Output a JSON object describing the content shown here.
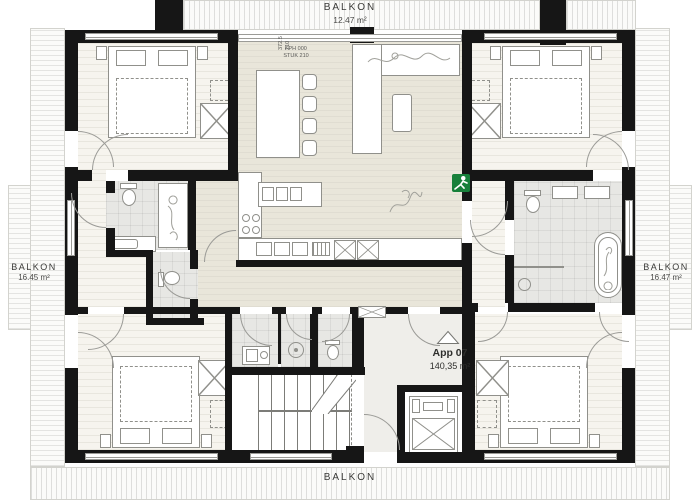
{
  "apartment": {
    "name": "App 07",
    "area": "140,35 m²"
  },
  "balconies": {
    "top": {
      "label": "BALKON",
      "area": "12.47 m²"
    },
    "left": {
      "label": "BALKON",
      "area": "16.45 m²"
    },
    "right": {
      "label": "BALKON",
      "area": "16.47 m²"
    },
    "bottom": {
      "label": "BALKON"
    }
  },
  "annotations": {
    "door_dim_a": "372.5",
    "door_dim_b": "210",
    "door_note_1": "FPH 000",
    "door_note_2": "STUK 210"
  },
  "icons": {
    "exit_sign": "emergency-exit-icon",
    "north_marker": "triangle-marker-icon"
  },
  "colors": {
    "wall": "#161616",
    "exit-green": "#17803a",
    "floor-living": "#e9e6da",
    "floor-bedroom": "#f6f4ee",
    "floor-bath": "#e7e7e4",
    "text": "#3b3b39"
  }
}
